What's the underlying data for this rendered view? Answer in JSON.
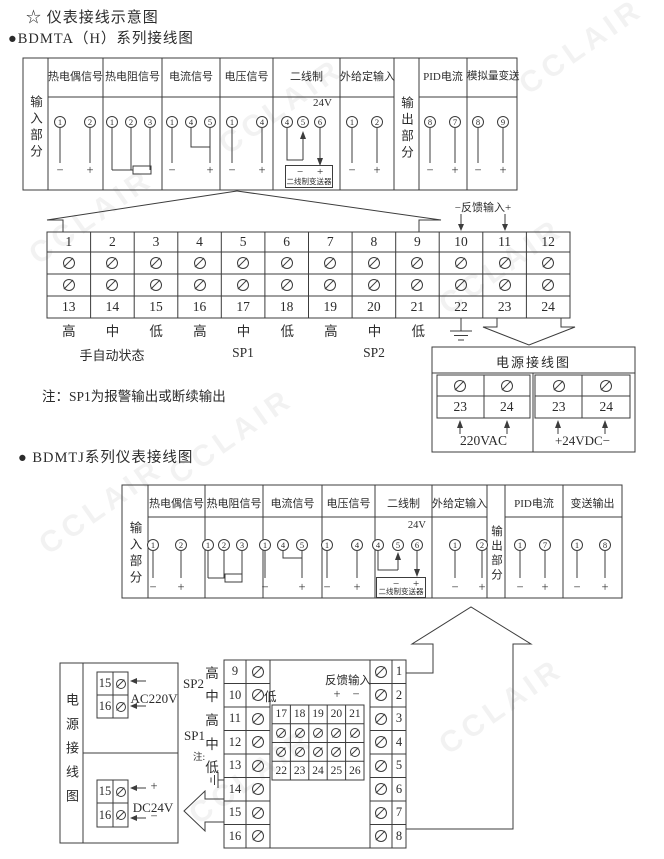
{
  "page": {
    "title": "☆ 仪表接线示意图",
    "section1_title": "●BDMTA（H）系列接线图",
    "section2_title": "● BDMTJ系列仪表接线图",
    "note": "注：SP1为报警输出或断续输出",
    "watermark": "CCLAIR"
  },
  "table1": {
    "input_label": "输入部分",
    "output_label": "输出部分",
    "thermocouple": {
      "label": "热电偶信号",
      "t1": "1",
      "t2": "2",
      "neg": "−",
      "pos": "+"
    },
    "rtd": {
      "label": "热电阻信号",
      "t1": "1",
      "t2": "2",
      "t3": "3"
    },
    "current": {
      "label": "电流信号",
      "t1": "1",
      "t2": "4",
      "t3": "5",
      "neg": "−",
      "pos": "+"
    },
    "voltage": {
      "label": "电压信号",
      "t1": "1",
      "t2": "4",
      "neg": "−",
      "pos": "+"
    },
    "two_wire": {
      "label": "二线制",
      "t1": "4",
      "t2": "5",
      "t3": "6",
      "v24": "24V",
      "neg": "−",
      "pos": "+",
      "transmitter": "二线制变送器"
    },
    "external": {
      "label": "外给定输入",
      "t1": "1",
      "t2": "2",
      "neg": "−",
      "pos": "+"
    },
    "pid": {
      "label": "PID电流",
      "t1": "8",
      "t2": "7",
      "neg": "−",
      "pos": "+"
    },
    "analog": {
      "label": "模拟量变送",
      "t1": "8",
      "t2": "9",
      "neg": "−",
      "pos": "+"
    }
  },
  "terminal_block1": {
    "top": [
      "1",
      "2",
      "3",
      "4",
      "5",
      "6",
      "7",
      "8",
      "9",
      "10",
      "11",
      "12"
    ],
    "bottom": [
      "13",
      "14",
      "15",
      "16",
      "17",
      "18",
      "19",
      "20",
      "21",
      "22",
      "23",
      "24"
    ],
    "hml": [
      "高",
      "中",
      "低",
      "高",
      "中",
      "低",
      "高",
      "中",
      "低"
    ],
    "manual_label": "手自动状态",
    "sp1": "SP1",
    "sp2": "SP2",
    "feedback_label": "−反馈输入+"
  },
  "power1": {
    "title": "电源接线图",
    "ac": {
      "nums": [
        "23",
        "24"
      ],
      "label": "220VAC"
    },
    "dc": {
      "nums": [
        "23",
        "24"
      ],
      "label": "+24VDC−"
    }
  },
  "table2": {
    "input_label": "输入部分",
    "output_label": "输出部分",
    "thermocouple": {
      "label": "热电偶信号",
      "t1": "1",
      "t2": "2",
      "neg": "−",
      "pos": "+"
    },
    "rtd": {
      "label": "热电阻信号",
      "t1": "1",
      "t2": "2",
      "t3": "3"
    },
    "current": {
      "label": "电流信号",
      "t1": "1",
      "t2": "4",
      "t3": "5",
      "neg": "−",
      "pos": "+"
    },
    "voltage": {
      "label": "电压信号",
      "t1": "1",
      "t2": "4",
      "neg": "−",
      "pos": "+"
    },
    "two_wire": {
      "label": "二线制",
      "t1": "4",
      "t2": "5",
      "t3": "6",
      "v24": "24V",
      "neg": "−",
      "pos": "+",
      "transmitter": "二线制变送器"
    },
    "external": {
      "label": "外给定输入",
      "t1": "1",
      "t2": "2",
      "neg": "−",
      "pos": "+"
    },
    "pid": {
      "label": "PID电流",
      "t1": "1",
      "t2": "7",
      "neg": "−",
      "pos": "+"
    },
    "transmit": {
      "label": "变送输出",
      "t1": "1",
      "t2": "8",
      "neg": "−",
      "pos": "+"
    }
  },
  "terminal_block2": {
    "left_nums": [
      "9",
      "10",
      "11",
      "12",
      "13",
      "14",
      "15",
      "16"
    ],
    "right_nums": [
      "1",
      "2",
      "3",
      "4",
      "5",
      "6",
      "7",
      "8"
    ],
    "hml": [
      "高",
      "中",
      "高",
      "中",
      "低"
    ],
    "sp1": "SP1",
    "sp2": "SP2",
    "note_mark": "注:",
    "feedback_label": "反馈输入",
    "low_label": "低",
    "plus": "+",
    "minus": "−",
    "mini_top": [
      "17",
      "18",
      "19",
      "20",
      "21"
    ],
    "mini_bottom": [
      "22",
      "23",
      "24",
      "25",
      "26"
    ]
  },
  "power2": {
    "title": "电源接线图",
    "ac": {
      "nums": [
        "15",
        "16"
      ],
      "label": "AC220V"
    },
    "dc": {
      "nums": [
        "15",
        "16"
      ],
      "label": "DC24V",
      "plus": "+",
      "minus": "−"
    }
  }
}
